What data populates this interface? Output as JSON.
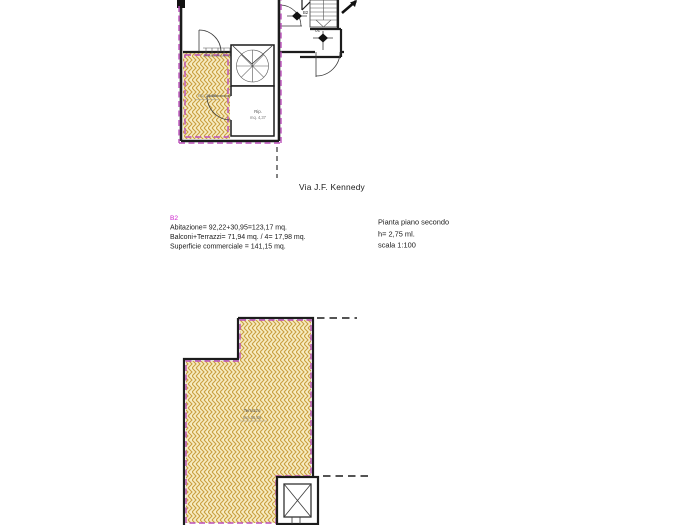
{
  "street_label": "Via J.F. Kennedy",
  "unit_info": {
    "code": "B2",
    "line1": "Abitazione= 92,22+30,95=123,17 mq.",
    "line2": "Balconi+Terrazzi= 71,94 mq. / 4= 17,98 mq.",
    "line3": "Superficie commerciale = 141,15 mq."
  },
  "plan_info": {
    "title": "Pianta piano secondo",
    "height": "h= 2,75 ml.",
    "scale": "scala 1:100"
  },
  "upper_plan": {
    "balcony_area": "mq. 16,08",
    "storage_label": "Rip.",
    "storage_area": "mq. 4,37",
    "door_label_1": "B2",
    "door_label_2": "B2"
  },
  "lower_plan": {
    "terrace_label": "Terrazzo",
    "terrace_area": "mq. 55,86"
  },
  "colors": {
    "boundary": "#bb4fbb",
    "accent": "#cc22cc",
    "wall": "#1c1c1c",
    "hatch_fill": "#f7ecc2",
    "hatch_stroke": "#c99e3f"
  }
}
